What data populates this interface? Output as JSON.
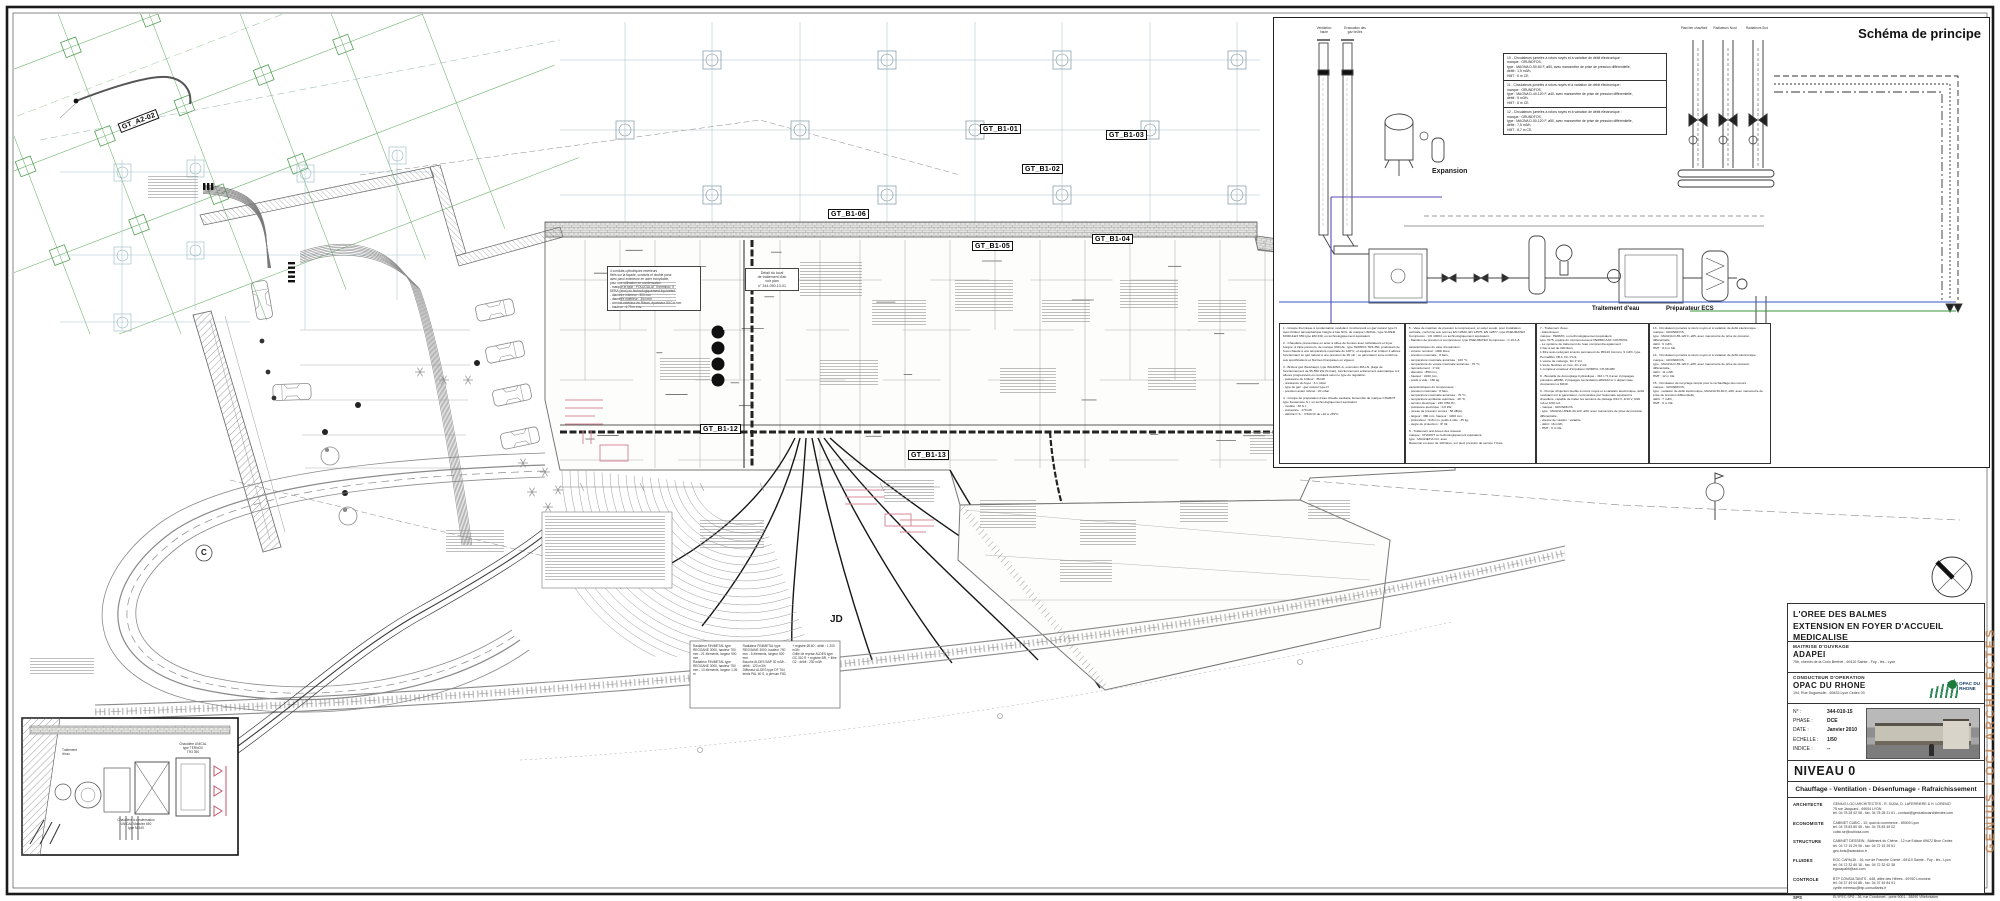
{
  "plan": {
    "labels": {
      "gt_a2_02": "GT_A2-02",
      "gt_b1_01": "GT_B1-01",
      "gt_b1_02": "GT_B1-02",
      "gt_b1_03": "GT_B1-03",
      "gt_b1_04": "GT_B1-04",
      "gt_b1_05": "GT_B1-05",
      "gt_b1_06": "GT_B1-06",
      "gt_b1_12": "GT_B1-12",
      "gt_b1_13": "GT_B1-13",
      "jd": "JD",
      "c_marker": "C"
    },
    "detail_note": "Détail du local\nde traitement d'air\nvoir plan\nn° 344-050-13-01",
    "conduits_note": "4 conduits cylindriques extérieurs\nfixés sur la façade, conduits et double paroi\navec paroi extérieure en acier inoxydable,\npour une utilisation en condensation\n- marque et type : POUJOULAT Therminox Ti\n  DEBA (Inox) ou technologiquement équivalent\n- diamètre intérieur : 300 mm\n- diamètre extérieur : 354 mm\n- conduit extérieur en Rilsan, épaisseur 8/10 e mm\n- hauteur : 4,70 m env.",
    "inset": {
      "boiler1": "Chaudière UNICAL\ntype TERNOX\nTR3 350",
      "boiler2": "Chaudière à condensation\nUNICAL Modulex 650\ntype M 340",
      "water": "Traitement\nd'eau"
    },
    "radiator_legend": {
      "items": [
        "Radiateur FINIMETAL type REGGANE 3000, hauteur 750 mm - 21 éléments, largeur 900 mm",
        "Radiateur FINIMETAL type REGGANE 3000, hauteur 750 mm - 13 éléments, largeur 1,05 m",
        "Radiateur FINIMETAL type REGGANE 3000, hauteur 750 mm - 5 éléments, largeur 520 mm",
        "Bouche ALDES BAP 30 m3/h - débit : 120 m3/h",
        "Diffuseur ALDES type DF 764 temis PAL 60 S, à plénum F80, + registre Ø160 - débit : 1 200 m3/h",
        "Grille de reprise ALDES type GC 310 R + registre BR, + filtre G2 - débit : 230 m3/h"
      ]
    }
  },
  "schema": {
    "title": "Schéma de principe",
    "chimney1": "Ventilation\nhaute",
    "chimney2": "Evacuation des\ngaz brûlés",
    "expansion": "Expansion",
    "traitement": "Traitement d'eau",
    "preparateur": "Préparateur ECS",
    "riser1": "Plancher chauffant",
    "riser2": "Radiateurs Nord",
    "riser3": "Radiateurs Sud",
    "pump_notes": [
      "10 - Circulateurs jumelés à rotors noyés et à variation de débit électronique :\nmarque : GRUNDFOS,\ntype : MAGNA D-50-60 F, ø50, avec manomètre de prise de pression différentielle,\ndébit : 1,5 m3/h,\nHMT : 6 m CE.",
      "11 - Circulateurs jumelés à rotors noyés et à variation de débit électronique :\nmarque : GRUNDFOS,\ntype : MAGNA D-40-120 F, ø40, avec manomètre de prise de pression différentielle,\ndébit : 5 m3/h,\nHMT : 8 m CE.",
      "12 - Circulateurs jumelés à rotors noyés et à variation de débit électronique :\nmarque : GRUNDFOS,\ntype : MAGNA D-50-120 F, ø50, avec manomètre de prise de pression différentielle,\ndébit : 7,5 m3/h,\nHMT : 8,7 m CE."
    ],
    "legend_columns": [
      {
        "paras": [
          "1 - Groupe thermique à condensation modulant, fonctionnant en gaz naturel type N, avec brûleur atmosphérique intégré à bas NOx, de marque UNICAL, type SUPER MODULEX 650 type EM 340, ou technologiquement équivalent",
          "2 - Chaudière pressurisée en acier à tubes de fumées avec turbulateurs et foyer borgne, à triple parcours, de marque UNICAL, type TERNOX TR3-350, produisant de l'eau chaude à une température maximale de 100°C, et équipée d'un brûleur 2 allures fonctionnant en gaz naturel à une pression de 20 mb ; ce générateur sera conforme aux spécifications et Normes Françaises en vigueur.",
          "3 - Brûleur gaz Weishaupt, type WG40N/1-A, exécution ZM-LN, plage de fonctionnement de 55-550 kW (N-Gaz), fonctionnement entièrement automatique à 2 allures progressives ou modulant selon le type de régulation\n- puissance du brûleur : 35 kW\n- résistance du foyer : 3,1 mbar\n- type de gaz : gaz naturel type N\n- pression avant robinet : 20 mbar",
          "4 - Groupe de préparation d'eau chaude sanitaire. Ensemble de marque CHAROT type Festemaxe S.I. ou technologiquement équivalent\n- modèle : 40 S.I.\n- puissance : 170 kW\n- débit E.C.S. : 3 500 l/h de +10 à +55°C."
        ]
      },
      {
        "paras": [
          "5 - Vase de maintien de pression à compresseur, en acier soudé, pour installation verticale, conforme aux normes EN 13520, EN 13575, EN 12877, type PNEUMATEX Compresso - CO 10004, ou technologiquement équivalent.\n- Maintien de pression à compresseur, type PNEUMATEX Compresso - C 10.1-8.",
          "caractéristiques du vase d'expansion :\n- volume nominal : 1000 litres,\n- pression maximale : 8 bars,\n- température maximale autorisée : 100 °C,\n- température de vessie maximale autorisée : 70 °C,\n- raccordement : 1\"1/2,\n- diamètre : 850 mm,\n- hauteur : 2100 mm,\n- poids à vide : 160 kg.",
          "caractéristiques du compresseur :\n- pression maximale : 8 bars,\n- température maximale autorisée : 70 °C,\n- température ambiante autorisée : 40 °C,\n- tension électrique : 230 V/50 Hz,\n- puissance électrique : 0,8 kW,\n- niveau de pression sonore : 58 dB(A),\n- largeur : 380 mm, hauteur : 1000 mm,\n- profondeur : 516 mm, poids à vide : 35 kg,\n- degré de protection : IP 32.",
          "6 - Traitement anti-boues des réseaux\nmarque : CHAROT ou technologiquement équivalent,\ntype : MAGNETIA CO, avec\nRéservoir en acier de 100 litres, sur pied, pression de service 7 bars."
        ]
      },
      {
        "paras": [
          "7 - Traitement d'eau\n- Adoucisseur\nmarque : PERMO, ou technologiquement équivalent,\ntype 7075, équipé du microprocesseur PERMO AAK CONTROL\n- Le système de traitement de l'eau comprendra également :\n1 bac à sel de 200 litres,\n1 filtre auto-nettoyant à tamis permanent de 95/110 microns, 9 m3/h, type Permafiltre VB A, Dn 1\"1/2,\n1 vanne de mélange, Dn 1\"1/4,\n1 kit de flexibles en inox, Dn 1\"1/2,\n1 compteur émetteur d'impulsion OZIRPVL CH-68-080",
          "8 - Bouteille de découplage hydraulique - 316 l / 5,3 avec 2 piquages primaires ø80/80, 2 piquages secondaires ø80/102 et 1 départ vase d'expansion à 60/49.",
          "9 - Pompe d'injection double à rotors noyés et à variation électronique, débit modulant sur le générateur, commandée par l'automate équipant la chaudière, capable de traiter les tensions de pilotage 0/10 V, 2/10 V, 0/20 mA et 4/20 mA\n- marque : GRUNDFOS\n- type : MAGNA UPED-40-120, ø60, avec manomètre de prise de pression différentielle,\n- vitesse de rotation : variable,\n- débit : 16 m3/h,\n- HMT : 9 m CE."
        ]
      },
      {
        "paras": [
          "13 - Circulateurs jumelés à rotors noyés et à variation de débit électronique :\nmarque : GRUNDFOS,\ntype : MAGNA D-65-120 F, ø65, avec manomètre de prise de pression différentielle,\ndébit : 9 m3/h,\nHMT : 8,3 m CE.",
          "14 - Circulateurs jumelés à rotors noyés et à variation de débit électronique :\nmarque : GRUNDFOS,\ntype : MAGNA D-65-120 F, ø65, avec manomètre de prise de pression différentielle,\ndébit : 11 m3/h,\nHMT : 12 m CE.",
          "15 - Circulateur de recyclage simple pour le réchauffage des retours :\nmarque : GRUNDFOS,\ntype : variation de débit électronique, MAGNA 50-60 F, ø50, avec manomètre de prise de pression différentielle,\ndébit : 7 m3/h,\nHMT : 6 m CE."
        ]
      }
    ]
  },
  "title_block": {
    "project_line1": "L'OREE DES BALMES",
    "project_line2": "EXTENSION EN FOYER D'ACCUEIL MEDICALISE",
    "maitrise_label": "MAITRISE D'OUVRAGE",
    "maitrise_name": "ADAPEI",
    "maitrise_addr": "75b, chemin de la Croix Berthet - 69110 Sainte - Foy - lès - Lyon",
    "conducteur_label": "CONDUCTEUR D'OPERATION",
    "conducteur_name": "OPAC DU RHONE",
    "conducteur_addr": "194, Rue Duguesclin - 69433 Lyon Cedex 03",
    "opac_logo_text": "OPAC DU\nRHONE",
    "meta": {
      "num_label": "N° :",
      "num": "344-010-15",
      "phase_label": "PHASE :",
      "phase": "DCE",
      "date_label": "DATE :",
      "date": "Janvier 2010",
      "echelle_label": "ECHELLE :",
      "echelle": "1/50",
      "indice_label": "INDICE :",
      "indice": "--"
    },
    "niveau": "NIVEAU 0",
    "subtitle": "Chauffage - Ventilation - Désenfumage - Rafraîchissement",
    "contributors": [
      {
        "role": "ARCHITECTE",
        "txt": "GENIUS LOCI ARCHITECTES - R. SUDA, D. LAFERRIERE & H. LORENZI\n75 rue Jacquard - 69004 LYON\ntél. 04 78 28 02 08 - fax. 04 78 28 21 61 - contact@geniuslociarchitectes.com"
      },
      {
        "role": "ECONOMISTE",
        "txt": "CABINET CUBIC - 13, quai du commerce - 69009 Lyon\ntél. 04 78 83 80 08 - fax. 04 78 83 49 02\ncubic.se@cubicsa.com"
      },
      {
        "role": "STRUCTURE",
        "txt": "CABINET DESSEIN - Bâtiment du Chêne - 12 rue Edison 69672 Bron Cedex\ntél. 04 72 15 29 06 - fax. 04 72 15 29 51\ngeo.bois@wanadoo.fr"
      },
      {
        "role": "FLUIDES",
        "txt": "EGC CAPALDI - 16, rue de Franche Comté - 69110 Sainte - Foy - lès - Lyon\ntél. 04 72 32 60 18 - fax. 04 72 32 62 38\negccapaldi@aol.com"
      },
      {
        "role": "CONTROLE",
        "txt": "BTP CONSULTANTS - 648, allée des Hêtres - 69760 Limonest\ntél. 04 37 49 04 88 - fax. 04 37 49 84 91\ncyrille.merreau@btp-consultants.fr"
      },
      {
        "role": "SPS",
        "txt": "ELYFEC SPS - 26, rue Condorcet - porte 9001 - 38090 Villefontaine"
      }
    ],
    "doc_number": "344-010-15",
    "watermark": "GENIUS LOCI ARCHITECTES"
  },
  "colors": {
    "accent_orange": "#bf7f4f",
    "grid_green": "#5aa85a",
    "grid_cyan": "#9fc3c9",
    "pipe_blue": "#3a57c9",
    "pipe_violet": "#5b4bb5",
    "pipe_green": "#3a9a3a",
    "accent_pink": "#d98a9a"
  }
}
